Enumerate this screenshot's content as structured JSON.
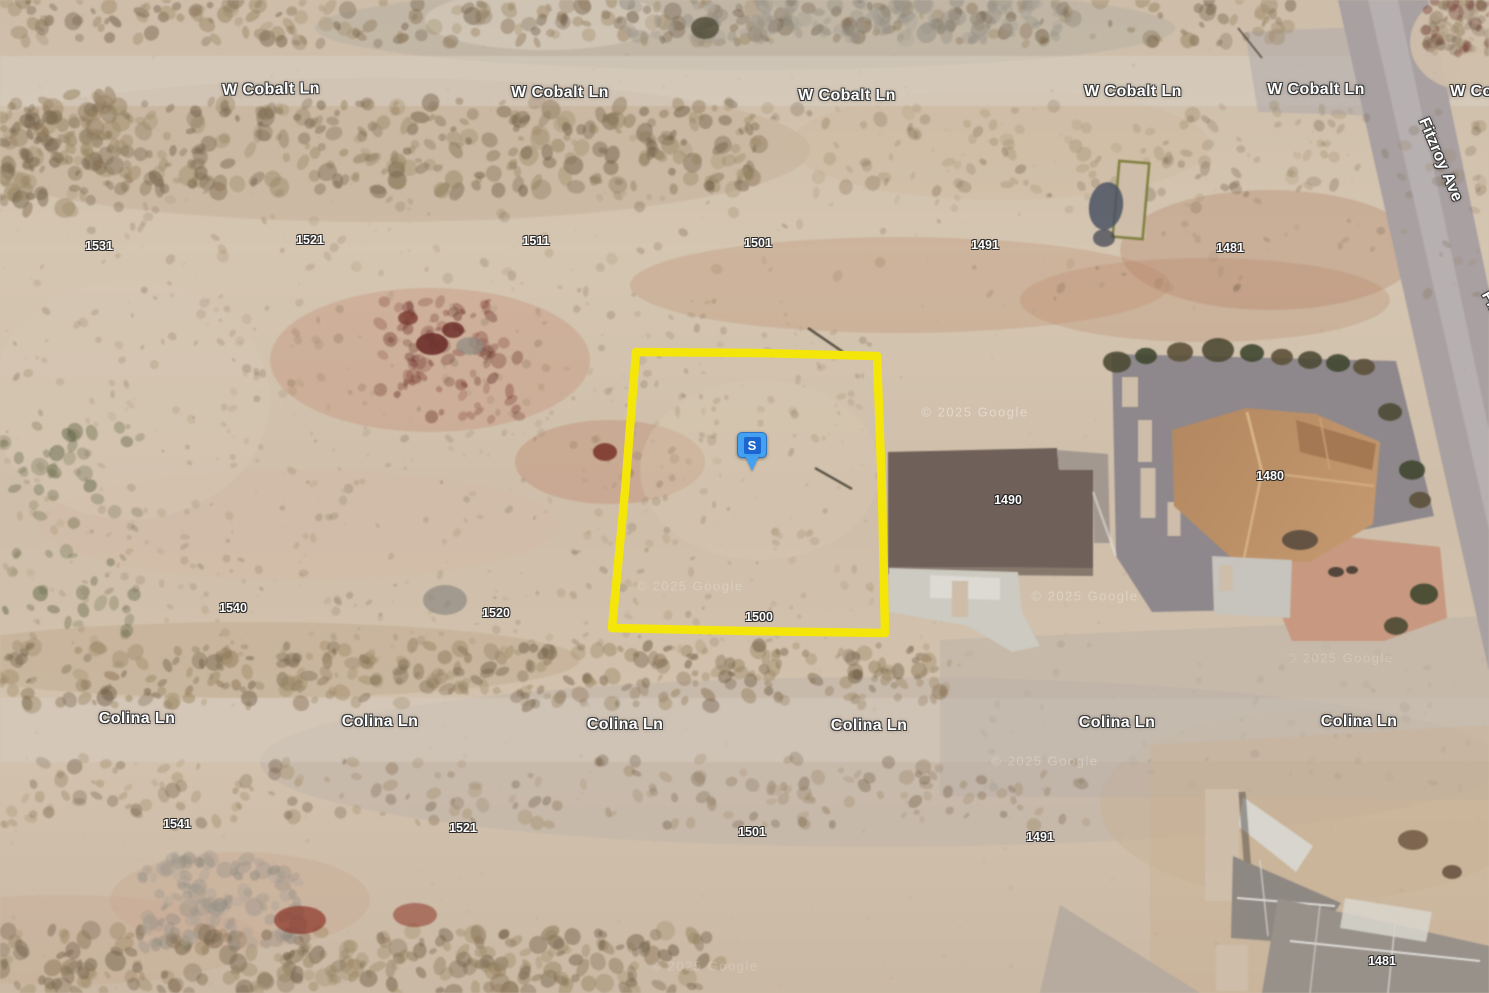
{
  "map": {
    "view_type": "satellite-aerial",
    "street_labels": [
      {
        "text": "W Cobalt Ln",
        "x": 271,
        "y": 90,
        "rotate": -1
      },
      {
        "text": "W Cobalt Ln",
        "x": 560,
        "y": 93,
        "rotate": 0
      },
      {
        "text": "W Cobalt Ln",
        "x": 847,
        "y": 96,
        "rotate": 0
      },
      {
        "text": "W Cobalt Ln",
        "x": 1133,
        "y": 92,
        "rotate": 0
      },
      {
        "text": "W Cobalt Ln",
        "x": 1316,
        "y": 90,
        "rotate": 0
      },
      {
        "text": "W Cobalt Ln",
        "x": 1499,
        "y": 92,
        "rotate": 0
      },
      {
        "text": "Fitzroy Ave",
        "x": 1440,
        "y": 160,
        "rotate": 67
      },
      {
        "text": "Fitzroy Ave",
        "x": 1506,
        "y": 332,
        "rotate": 62
      },
      {
        "text": "Colina Ln",
        "x": 137,
        "y": 719,
        "rotate": 0
      },
      {
        "text": "Colina Ln",
        "x": 380,
        "y": 722,
        "rotate": 0
      },
      {
        "text": "Colina Ln",
        "x": 625,
        "y": 725,
        "rotate": 0
      },
      {
        "text": "Colina Ln",
        "x": 869,
        "y": 726,
        "rotate": 0
      },
      {
        "text": "Colina Ln",
        "x": 1117,
        "y": 723,
        "rotate": 0
      },
      {
        "text": "Colina Ln",
        "x": 1359,
        "y": 722,
        "rotate": 0
      }
    ],
    "parcel_labels": [
      {
        "text": "1531",
        "x": 99,
        "y": 246
      },
      {
        "text": "1521",
        "x": 310,
        "y": 240
      },
      {
        "text": "1511",
        "x": 536,
        "y": 241
      },
      {
        "text": "1501",
        "x": 758,
        "y": 243
      },
      {
        "text": "1491",
        "x": 985,
        "y": 245
      },
      {
        "text": "1481",
        "x": 1230,
        "y": 248
      },
      {
        "text": "1540",
        "x": 233,
        "y": 608
      },
      {
        "text": "1520",
        "x": 496,
        "y": 613
      },
      {
        "text": "1500",
        "x": 759,
        "y": 617
      },
      {
        "text": "1490",
        "x": 1008,
        "y": 500
      },
      {
        "text": "1480",
        "x": 1270,
        "y": 476
      },
      {
        "text": "1541",
        "x": 177,
        "y": 824
      },
      {
        "text": "1521",
        "x": 463,
        "y": 828
      },
      {
        "text": "1501",
        "x": 752,
        "y": 832
      },
      {
        "text": "1491",
        "x": 1040,
        "y": 837
      },
      {
        "text": "1481",
        "x": 1382,
        "y": 961
      }
    ],
    "watermarks": [
      {
        "text": "© 2025 Google",
        "x": 975,
        "y": 412,
        "opacity": 0.38
      },
      {
        "text": "© 2025 Google",
        "x": 690,
        "y": 586,
        "opacity": 0.22
      },
      {
        "text": "© 2025 Google",
        "x": 1085,
        "y": 596,
        "opacity": 0.28
      },
      {
        "text": "© 2025 Google",
        "x": 1045,
        "y": 761,
        "opacity": 0.25
      },
      {
        "text": "© 2025 Google",
        "x": 705,
        "y": 966,
        "opacity": 0.2
      },
      {
        "text": "© 2025 Google",
        "x": 1340,
        "y": 658,
        "opacity": 0.2
      }
    ],
    "marker": {
      "label": "S",
      "x": 752,
      "y": 445,
      "body_color": "#44a1f1",
      "inner_color": "#1b66d0"
    },
    "highlight_parcel": {
      "number": "1500",
      "stroke": "#f5e60a",
      "points": "636,352 758,353 877,356 882,492 885,633 747,631 612,628 625,491"
    }
  }
}
